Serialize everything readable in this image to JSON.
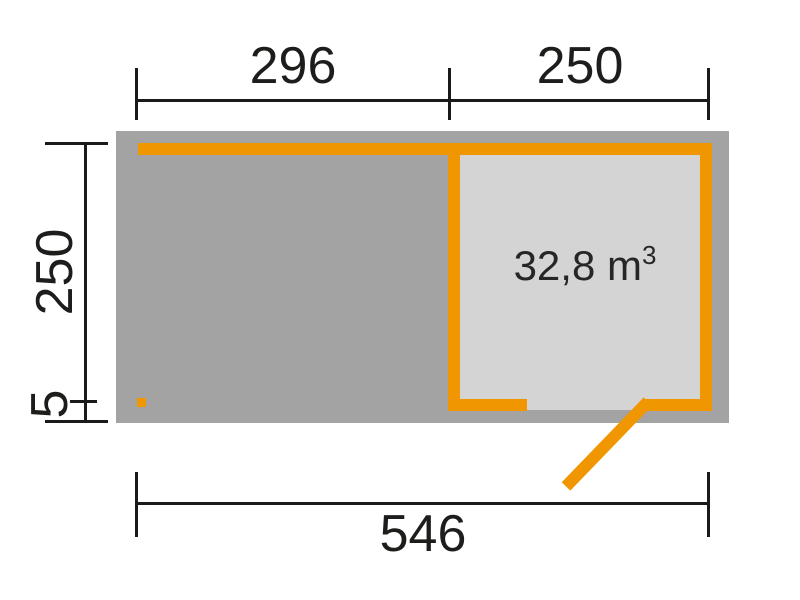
{
  "diagram": {
    "kind": "shed-floor-plan",
    "volume": {
      "value": "32,8 m",
      "sup": "3"
    },
    "dimensions": {
      "top_left_segment": "296",
      "top_right_segment": "250",
      "side_height": "250",
      "side_overhang": "5",
      "total_width": "546"
    },
    "colors": {
      "wall_orange": "#f09600",
      "footprint_gray": "#a3a3a3",
      "room_gray": "#d4d4d4",
      "dimension_black": "#1a1a1a",
      "background": "#ffffff"
    }
  }
}
